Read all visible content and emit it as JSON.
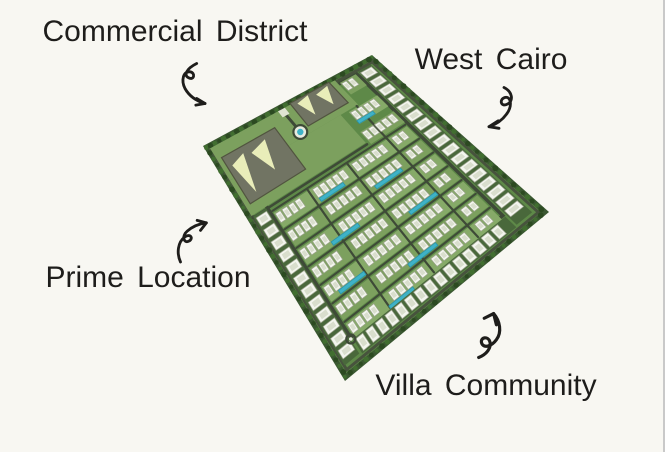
{
  "annotations": [
    {
      "id": "commercial-district",
      "label": "Commercial District",
      "arrow": "curved-arrow-down-right"
    },
    {
      "id": "west-cairo",
      "label": "West Cairo",
      "arrow": "curved-arrow-down-left"
    },
    {
      "id": "prime-location",
      "label": "Prime Location",
      "arrow": "curved-arrow-up-right"
    },
    {
      "id": "villa-community",
      "label": "Villa Community",
      "arrow": "curved-arrow-up-left"
    }
  ],
  "map": {
    "kind": "residential-master-plan-aerial",
    "visible_features": [
      "commercial district blocks with pale rooftops",
      "rows of white villa buildings",
      "turquoise swimming pools and lagoons",
      "central roundabout",
      "perimeter road lined with trees",
      "edge strips of villas on all sides"
    ]
  },
  "colors": {
    "background": "#f8f7f2",
    "text": "#1e1d1b",
    "divider_gray": "#c9c9c9",
    "perimeter_green": "#3b5832",
    "inner_green": "#5e8948",
    "lawn_green_a": "#86aa68",
    "lawn_green_b": "#7ca05e",
    "strip_green": "#49683b",
    "road_dark": "#3e4a37",
    "road_light_edge": "#47533d",
    "tree_dark": "#2c4a21",
    "tree_light": "#416e30",
    "building_white": "#f3f5ee",
    "building_shade": "#d9decd",
    "building_stroke": "#9aa28b",
    "commercial_gray": "#717463",
    "commercial_stroke": "#51543f",
    "commercial_pale": "#e9edb9",
    "pool_teal": "#3fb2c6",
    "pool_edge": "#2a93a8",
    "roundabout_ring": "#e8ebdf"
  }
}
